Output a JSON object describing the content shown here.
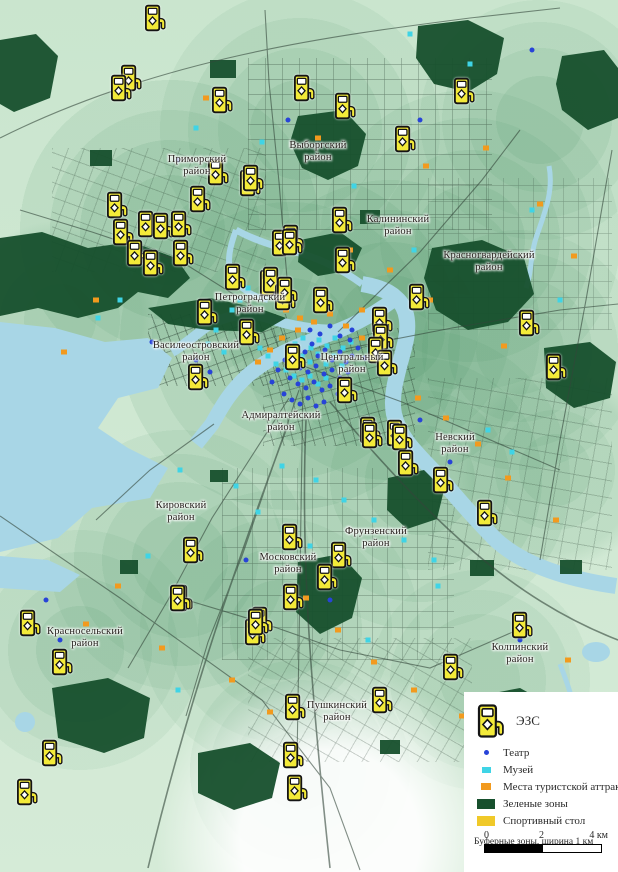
{
  "legend": {
    "ev_label": "ЭЗС",
    "items": [
      {
        "key": "theater",
        "label": "Театр"
      },
      {
        "key": "museum",
        "label": "Музей"
      },
      {
        "key": "attraction",
        "label": "Места туристской аттракции"
      },
      {
        "key": "green",
        "label": "Зеленые зоны"
      },
      {
        "key": "sport",
        "label": "Спортивный стол"
      }
    ],
    "buffer_note": "Буферные зоны, ширина 1 км",
    "scale": {
      "tick0": "0",
      "tick2": "2",
      "tick4": "4 км"
    }
  },
  "colors": {
    "theater": "#2743d8",
    "museum": "#3fd4e6",
    "attraction": "#f29a1e",
    "green": "#17502d",
    "sport": "#f0c929",
    "water": "#a8d6e6",
    "ev_yellow": "#f3ea39"
  },
  "map": {
    "districts": [
      {
        "name": "Приморский\nрайон",
        "x": 197,
        "y": 166
      },
      {
        "name": "Выборгский\nрайон",
        "x": 318,
        "y": 152
      },
      {
        "name": "Калининский\nрайон",
        "x": 398,
        "y": 226
      },
      {
        "name": "Красногвардейский\nрайон",
        "x": 489,
        "y": 262
      },
      {
        "name": "Петроградский\nрайон",
        "x": 250,
        "y": 304
      },
      {
        "name": "Василеостровский\nрайон",
        "x": 196,
        "y": 352
      },
      {
        "name": "Центральный\nрайон",
        "x": 352,
        "y": 364
      },
      {
        "name": "Адмиралтейский\nрайон",
        "x": 281,
        "y": 422
      },
      {
        "name": "Невский\nрайон",
        "x": 455,
        "y": 444
      },
      {
        "name": "Кировский\nрайон",
        "x": 181,
        "y": 512
      },
      {
        "name": "Фрунзенский\nрайон",
        "x": 376,
        "y": 538
      },
      {
        "name": "Московский\nрайон",
        "x": 288,
        "y": 564
      },
      {
        "name": "Красносельский\nрайон",
        "x": 85,
        "y": 638
      },
      {
        "name": "Колпинский\nрайон",
        "x": 520,
        "y": 654
      },
      {
        "name": "Пушкинский\nрайон",
        "x": 337,
        "y": 712
      }
    ],
    "ev_stations": [
      [
        155,
        18
      ],
      [
        131,
        78
      ],
      [
        121,
        88
      ],
      [
        222,
        100
      ],
      [
        304,
        88
      ],
      [
        345,
        106
      ],
      [
        405,
        139
      ],
      [
        464,
        91
      ],
      [
        250,
        183
      ],
      [
        218,
        172
      ],
      [
        200,
        199
      ],
      [
        117,
        205
      ],
      [
        148,
        224
      ],
      [
        163,
        226
      ],
      [
        181,
        224
      ],
      [
        123,
        232
      ],
      [
        137,
        253
      ],
      [
        153,
        263
      ],
      [
        183,
        253
      ],
      [
        235,
        277
      ],
      [
        253,
        178
      ],
      [
        293,
        238
      ],
      [
        342,
        220
      ],
      [
        345,
        260
      ],
      [
        419,
        297
      ],
      [
        529,
        323
      ],
      [
        556,
        367
      ],
      [
        282,
        243
      ],
      [
        292,
        242
      ],
      [
        270,
        283
      ],
      [
        273,
        280
      ],
      [
        285,
        297
      ],
      [
        287,
        290
      ],
      [
        323,
        300
      ],
      [
        198,
        377
      ],
      [
        207,
        312
      ],
      [
        249,
        332
      ],
      [
        295,
        357
      ],
      [
        382,
        320
      ],
      [
        383,
        337
      ],
      [
        378,
        350
      ],
      [
        387,
        363
      ],
      [
        347,
        390
      ],
      [
        370,
        430
      ],
      [
        397,
        433
      ],
      [
        372,
        435
      ],
      [
        402,
        437
      ],
      [
        408,
        463
      ],
      [
        443,
        480
      ],
      [
        487,
        513
      ],
      [
        341,
        555
      ],
      [
        193,
        550
      ],
      [
        182,
        598
      ],
      [
        292,
        537
      ],
      [
        327,
        577
      ],
      [
        262,
        620
      ],
      [
        255,
        632
      ],
      [
        62,
        662
      ],
      [
        30,
        623
      ],
      [
        52,
        753
      ],
      [
        27,
        792
      ],
      [
        180,
        598
      ],
      [
        258,
        622
      ],
      [
        293,
        597
      ],
      [
        295,
        707
      ],
      [
        293,
        755
      ],
      [
        382,
        700
      ],
      [
        453,
        667
      ],
      [
        522,
        625
      ],
      [
        297,
        788
      ]
    ],
    "theaters": [
      [
        296,
        348
      ],
      [
        305,
        352
      ],
      [
        312,
        344
      ],
      [
        318,
        356
      ],
      [
        325,
        350
      ],
      [
        332,
        360
      ],
      [
        340,
        352
      ],
      [
        346,
        362
      ],
      [
        352,
        356
      ],
      [
        300,
        368
      ],
      [
        308,
        372
      ],
      [
        316,
        366
      ],
      [
        324,
        374
      ],
      [
        332,
        370
      ],
      [
        340,
        378
      ],
      [
        348,
        372
      ],
      [
        290,
        378
      ],
      [
        298,
        384
      ],
      [
        306,
        388
      ],
      [
        314,
        382
      ],
      [
        322,
        390
      ],
      [
        330,
        386
      ],
      [
        338,
        394
      ],
      [
        284,
        394
      ],
      [
        292,
        400
      ],
      [
        300,
        404
      ],
      [
        308,
        398
      ],
      [
        316,
        406
      ],
      [
        324,
        402
      ],
      [
        285,
        360
      ],
      [
        278,
        370
      ],
      [
        272,
        382
      ],
      [
        350,
        340
      ],
      [
        358,
        348
      ],
      [
        365,
        358
      ],
      [
        310,
        330
      ],
      [
        320,
        334
      ],
      [
        330,
        326
      ],
      [
        340,
        336
      ],
      [
        352,
        330
      ],
      [
        196,
        360
      ],
      [
        210,
        372
      ],
      [
        152,
        342
      ],
      [
        420,
        420
      ],
      [
        450,
        462
      ],
      [
        246,
        560
      ],
      [
        420,
        120
      ],
      [
        60,
        640
      ],
      [
        330,
        600
      ],
      [
        520,
        640
      ],
      [
        46,
        600
      ],
      [
        532,
        50
      ],
      [
        288,
        120
      ],
      [
        178,
        160
      ]
    ],
    "museums": [
      [
        288,
        352
      ],
      [
        295,
        344
      ],
      [
        303,
        338
      ],
      [
        311,
        348
      ],
      [
        319,
        340
      ],
      [
        327,
        346
      ],
      [
        335,
        338
      ],
      [
        343,
        348
      ],
      [
        351,
        342
      ],
      [
        294,
        362
      ],
      [
        302,
        356
      ],
      [
        310,
        362
      ],
      [
        318,
        354
      ],
      [
        326,
        364
      ],
      [
        334,
        356
      ],
      [
        342,
        366
      ],
      [
        286,
        370
      ],
      [
        294,
        376
      ],
      [
        302,
        380
      ],
      [
        310,
        376
      ],
      [
        318,
        384
      ],
      [
        326,
        378
      ],
      [
        260,
        348
      ],
      [
        268,
        356
      ],
      [
        276,
        364
      ],
      [
        252,
        338
      ],
      [
        244,
        330
      ],
      [
        370,
        350
      ],
      [
        378,
        342
      ],
      [
        386,
        356
      ],
      [
        240,
        300
      ],
      [
        232,
        310
      ],
      [
        248,
        288
      ],
      [
        216,
        330
      ],
      [
        208,
        344
      ],
      [
        224,
        352
      ],
      [
        196,
        128
      ],
      [
        262,
        142
      ],
      [
        354,
        186
      ],
      [
        414,
        250
      ],
      [
        296,
        232
      ],
      [
        180,
        470
      ],
      [
        236,
        486
      ],
      [
        258,
        512
      ],
      [
        284,
        530
      ],
      [
        310,
        546
      ],
      [
        148,
        556
      ],
      [
        488,
        430
      ],
      [
        512,
        452
      ],
      [
        560,
        300
      ],
      [
        98,
        318
      ],
      [
        438,
        586
      ],
      [
        368,
        640
      ],
      [
        178,
        690
      ],
      [
        522,
        706
      ],
      [
        410,
        34
      ],
      [
        470,
        64
      ],
      [
        532,
        210
      ],
      [
        282,
        466
      ],
      [
        316,
        480
      ],
      [
        344,
        500
      ],
      [
        374,
        520
      ],
      [
        404,
        540
      ],
      [
        434,
        560
      ],
      [
        120,
        300
      ]
    ],
    "attractions": [
      [
        282,
        338
      ],
      [
        298,
        330
      ],
      [
        314,
        322
      ],
      [
        330,
        314
      ],
      [
        346,
        326
      ],
      [
        362,
        338
      ],
      [
        270,
        350
      ],
      [
        258,
        362
      ],
      [
        362,
        310
      ],
      [
        378,
        330
      ],
      [
        300,
        318
      ],
      [
        286,
        310
      ],
      [
        206,
        98
      ],
      [
        318,
        138
      ],
      [
        426,
        166
      ],
      [
        486,
        148
      ],
      [
        540,
        204
      ],
      [
        574,
        256
      ],
      [
        150,
        260
      ],
      [
        96,
        300
      ],
      [
        418,
        398
      ],
      [
        446,
        418
      ],
      [
        478,
        444
      ],
      [
        508,
        478
      ],
      [
        556,
        520
      ],
      [
        306,
        598
      ],
      [
        338,
        630
      ],
      [
        374,
        662
      ],
      [
        414,
        690
      ],
      [
        462,
        716
      ],
      [
        118,
        586
      ],
      [
        86,
        624
      ],
      [
        162,
        648
      ],
      [
        232,
        680
      ],
      [
        270,
        712
      ],
      [
        568,
        660
      ],
      [
        350,
        250
      ],
      [
        390,
        270
      ],
      [
        430,
        300
      ],
      [
        504,
        346
      ],
      [
        64,
        352
      ]
    ]
  }
}
